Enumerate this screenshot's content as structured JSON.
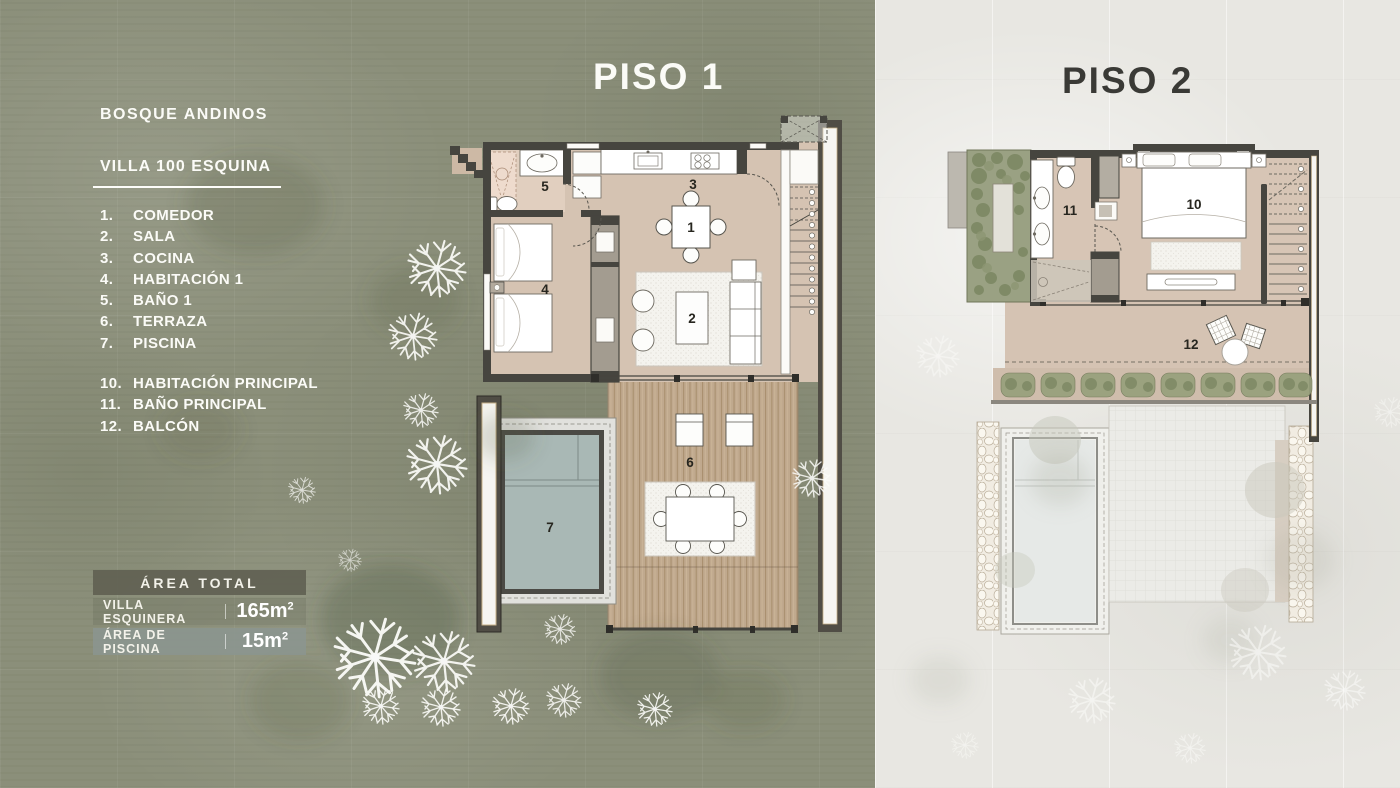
{
  "page": {
    "background_left": "#8b8f7a",
    "background_right": "#e8e7e2"
  },
  "info_panel": {
    "project_title": "BOSQUE ANDINOS",
    "villa_title": "VILLA 100 ESQUINA",
    "legend_piso1": [
      {
        "num": "1.",
        "label": "COMEDOR"
      },
      {
        "num": "2.",
        "label": "SALA"
      },
      {
        "num": "3.",
        "label": "COCINA"
      },
      {
        "num": "4.",
        "label": "HABITACIÓN 1"
      },
      {
        "num": "5.",
        "label": "BAÑO 1"
      },
      {
        "num": "6.",
        "label": "TERRAZA"
      },
      {
        "num": "7.",
        "label": "PISCINA"
      }
    ],
    "legend_piso2": [
      {
        "num": "10.",
        "label": "HABITACIÓN PRINCIPAL"
      },
      {
        "num": "11.",
        "label": "BAÑO PRINCIPAL"
      },
      {
        "num": "12.",
        "label": "BALCÓN"
      }
    ],
    "area_table": {
      "header": "ÁREA TOTAL",
      "rows": [
        {
          "label": "VILLA ESQUINERA",
          "value": "165m",
          "sup": "2"
        },
        {
          "label": "ÁREA DE PISCINA",
          "value": "15m",
          "sup": "2"
        }
      ]
    }
  },
  "floor1": {
    "title": "PISO 1",
    "labels": {
      "comedor": "1",
      "sala": "2",
      "cocina": "3",
      "habitacion_1": "4",
      "bano_1": "5",
      "terraza": "6",
      "piscina": "7"
    }
  },
  "floor2": {
    "title": "PISO 2",
    "labels": {
      "habitacion_principal": "10",
      "bano_principal": "11",
      "balcon": "12"
    }
  },
  "colors": {
    "wall": "#46453f",
    "floor": "#d5c3b2",
    "pool_water": "#a9b8b5",
    "wood_deck": "#c0a98e",
    "area_header_bg": "#616153",
    "area_row_bg": "#8b9590",
    "title_light": "#fbfbf7",
    "title_dark": "#3a3a36"
  }
}
